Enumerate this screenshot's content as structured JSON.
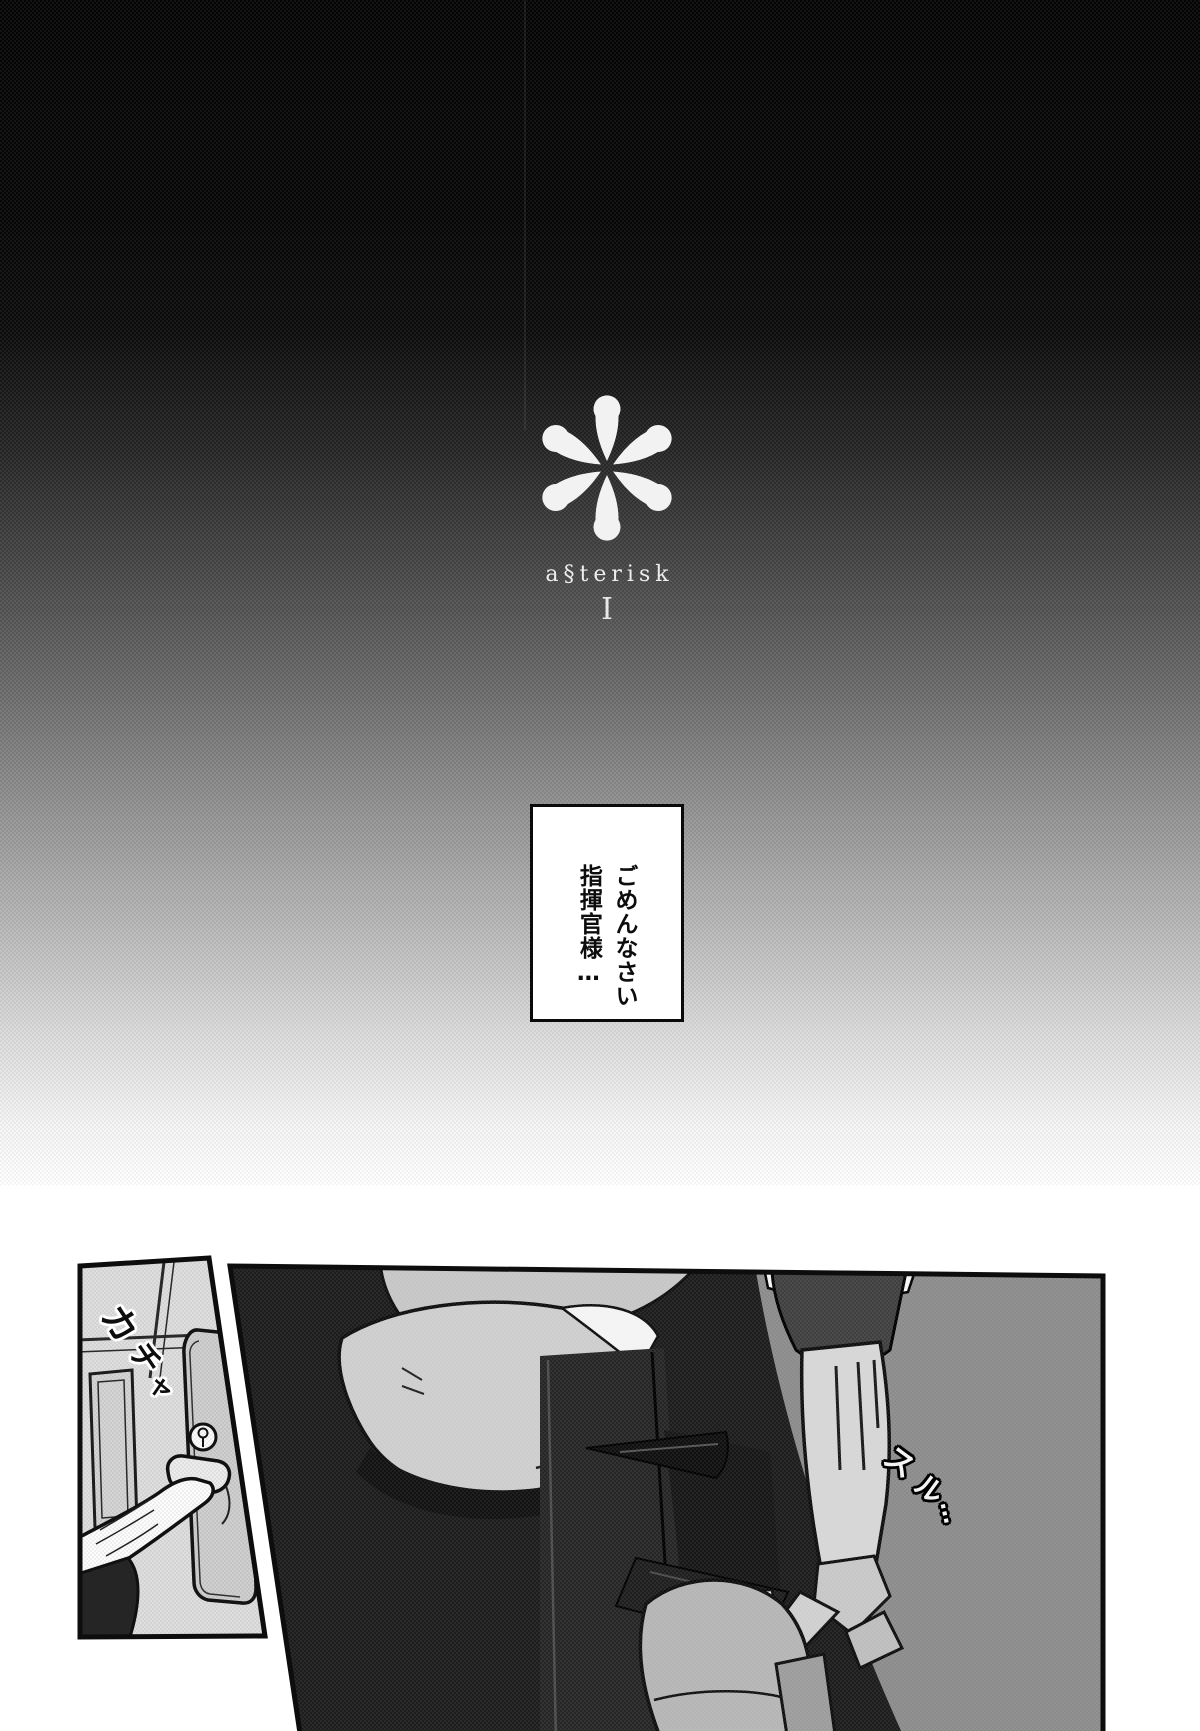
{
  "logo": {
    "icon": "asterisk-flower-icon",
    "title": "a§terisk",
    "numeral": "I",
    "color": "#f0f0f0"
  },
  "speech_bubble": {
    "lines": [
      "ごめんなさい",
      "指揮官様…"
    ]
  },
  "sfx": {
    "door": {
      "text": "カチャ",
      "chars": [
        "カ",
        "チ",
        "ャ"
      ]
    },
    "slide": {
      "text": "スル…",
      "chars": [
        "ス",
        "ル",
        "…"
      ]
    }
  },
  "colors": {
    "page_bg": "#ffffff",
    "gradient_top": "#050505",
    "gradient_bottom": "#ffffff",
    "panel_dark": "#1d1d1d",
    "panel_gray": "#8b8b8b",
    "panel_light": "#dedede",
    "ink": "#0d0d0d",
    "logo_white": "#f0f0f0"
  }
}
